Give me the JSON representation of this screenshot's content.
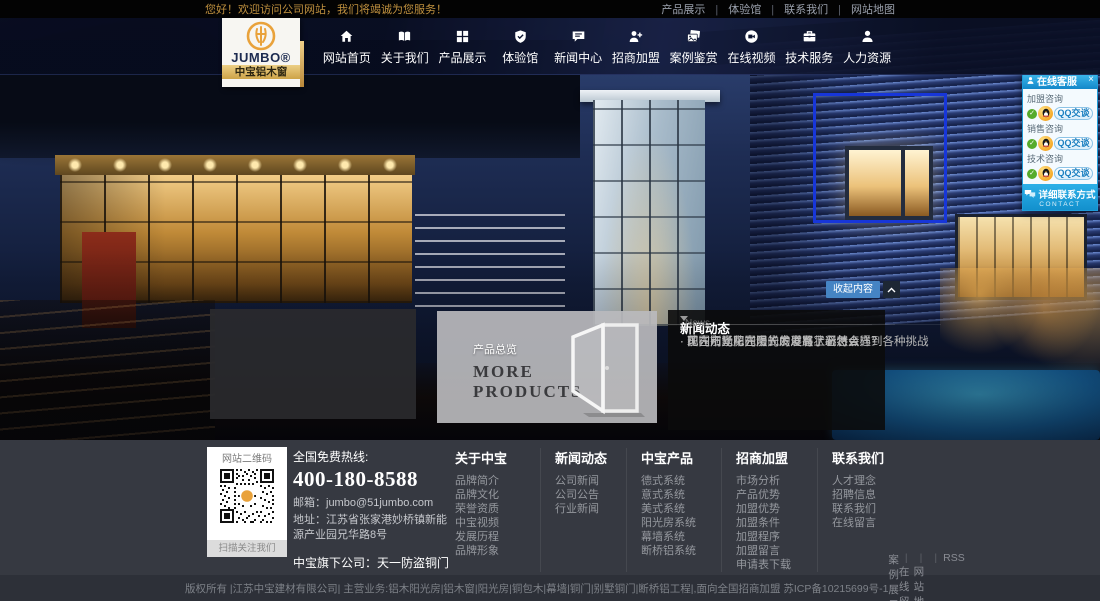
{
  "topbar": {
    "welcome": "您好！欢迎访问公司网站，我们将竭诚为您服务！",
    "links": [
      "产品展示",
      "体验馆",
      "联系我们",
      "网站地图"
    ]
  },
  "logo": {
    "brand": "JUMBO®",
    "subtitle": "中宝铝木窗"
  },
  "nav": {
    "items": [
      {
        "label": "网站首页",
        "icon": "home-icon"
      },
      {
        "label": "关于我们",
        "icon": "book-icon"
      },
      {
        "label": "产品展示",
        "icon": "grid-icon"
      },
      {
        "label": "体验馆",
        "icon": "shield-icon"
      },
      {
        "label": "新闻中心",
        "icon": "chat-icon"
      },
      {
        "label": "招商加盟",
        "icon": "user-plus-icon"
      },
      {
        "label": "案例鉴赏",
        "icon": "photos-icon"
      },
      {
        "label": "在线视频",
        "icon": "video-icon"
      },
      {
        "label": "技术服务",
        "icon": "briefcase-icon"
      },
      {
        "label": "人力资源",
        "icon": "user-icon"
      }
    ]
  },
  "service_panel": {
    "title": "在线客服",
    "close": "×",
    "groups": [
      {
        "label": "加盟咨询",
        "button": "QQ交谈"
      },
      {
        "label": "销售咨询",
        "button": "QQ交谈"
      },
      {
        "label": "技术咨询",
        "button": "QQ交谈"
      }
    ],
    "footer": "详细联系方式",
    "footer_sub": "CONTACT"
  },
  "hero": {
    "collapse_label": "收起内容"
  },
  "products_overlay": {
    "tag": "产品总览",
    "line1": "MORE",
    "line2": "PRODUCTS"
  },
  "news_panel": {
    "title": "新闻动态",
    "title_en": "News",
    "items": [
      "现在别墅阳光房的发展有了新特点",
      "国内市场花园阳光房发展状况怎么样？",
      "花园阳光房在漫长的道路上必然会遇到各种挑战"
    ]
  },
  "footer": {
    "qr_title": "网站二维码",
    "qr_caption": "扫描关注我们",
    "hotline_label": "全国免费热线:",
    "hotline_number": "400-180-8588",
    "email": "邮箱：jumbo@51jumbo.com",
    "address": "地址：江苏省张家港妙桥镇新能源产业园兄华路8号",
    "subsidiary": "中宝旗下公司：天一防盗铜门",
    "columns": [
      {
        "title": "关于中宝",
        "links": [
          "品牌简介",
          "品牌文化",
          "荣誉资质",
          "中宝视频",
          "发展历程",
          "品牌形象"
        ]
      },
      {
        "title": "新闻动态",
        "links": [
          "公司新闻",
          "公司公告",
          "行业新闻"
        ]
      },
      {
        "title": "中宝产品",
        "links": [
          "德式系统",
          "意式系统",
          "美式系统",
          "阳光房系统",
          "幕墙系统",
          "断桥铝系统"
        ]
      },
      {
        "title": "招商加盟",
        "links": [
          "市场分析",
          "产品优势",
          "加盟优势",
          "加盟条件",
          "加盟程序",
          "加盟留言",
          "申请表下载"
        ]
      },
      {
        "title": "联系我们",
        "links": [
          "人才理念",
          "招聘信息",
          "联系我们",
          "在线留言"
        ]
      }
    ]
  },
  "bottombar": {
    "copyright": "版权所有 |江苏中宝建材有限公司| 主营业务:铝木阳光房|铝木窗|阳光房|铜包木|幕墙|铜门|别墅铜门|断桥铝工程|,面向全国招商加盟 苏ICP备10215699号-1",
    "links": [
      "案例展示",
      "在线留言",
      "网站地图",
      "RSS"
    ]
  },
  "colors": {
    "accent_orange": "#e9a23b",
    "accent_cyan": "#29a9e1",
    "highlight_border": "#1736d9",
    "qq_link": "#1a7fc0"
  }
}
